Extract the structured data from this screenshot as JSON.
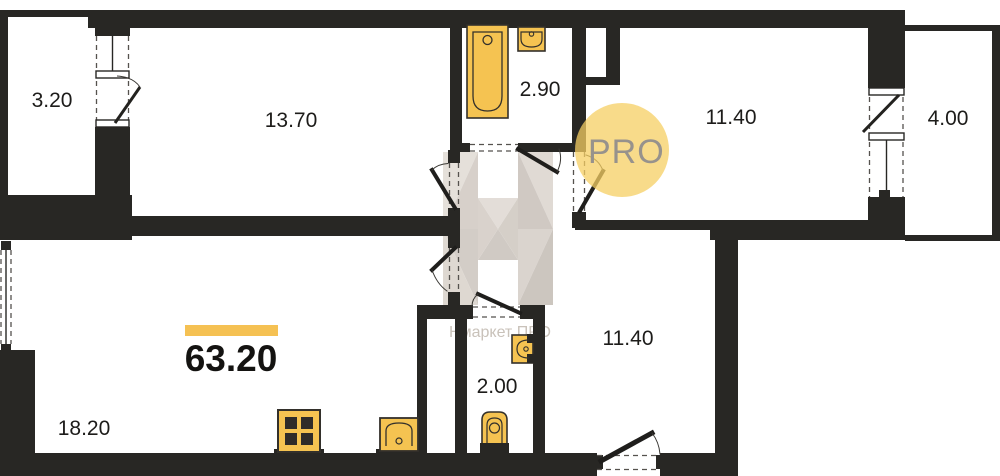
{
  "plan": {
    "total_area": "63.20",
    "rooms": [
      {
        "name": "balcony-left",
        "area": "3.20"
      },
      {
        "name": "living-room",
        "area": "13.70"
      },
      {
        "name": "bathroom",
        "area": "2.90"
      },
      {
        "name": "bedroom",
        "area": "11.40"
      },
      {
        "name": "balcony-right",
        "area": "4.00"
      },
      {
        "name": "kitchen-living-room",
        "area": "18.20"
      },
      {
        "name": "wc",
        "area": "2.00"
      },
      {
        "name": "hallway",
        "area": "11.40"
      }
    ],
    "logo": {
      "text": "PRO"
    },
    "watermark": {
      "text": "Нмаркет ПРО"
    },
    "colors": {
      "wall": "#282724",
      "fixture_fill": "#f5c351",
      "accent_bar": "#f5c153",
      "logo_circle": "#f6cf63",
      "logo_text": "#97928c",
      "watermark_gray": "#d5cec7"
    }
  }
}
